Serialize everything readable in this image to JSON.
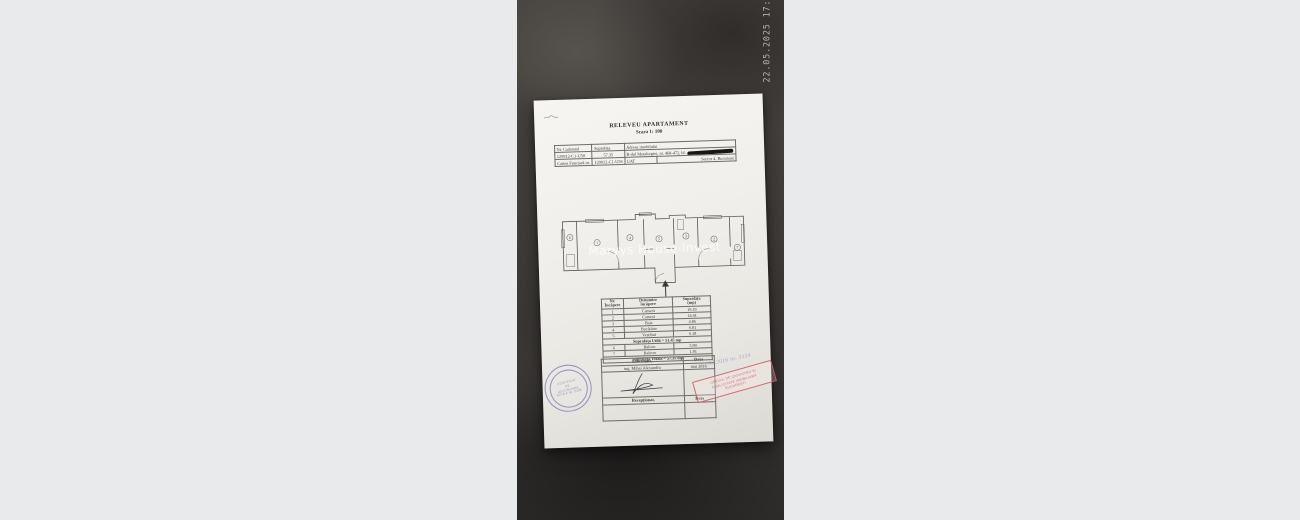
{
  "viewer": {
    "timestamp": "22.05.2025 17:21",
    "watermark": "Maryys House Invest"
  },
  "document": {
    "title": "RELEVEU APARTAMENT",
    "subtitle": "Scara 1: 100",
    "header_table": {
      "nr_cadastral_label": "Nr. Cadastral",
      "suprafata_label": "Suprafața",
      "adresa_label": "Adresa imobilului",
      "cadastral_no": "129912-C1-U58",
      "area_value": "57.35",
      "address": "B-dul Metalurgiei, nr. 468-472, bl.",
      "cf_label": "Cartea Funciară nr.",
      "cf_no": "129912-C1-U58",
      "uat_label": "UAT",
      "uat_value": "Sector 4, București"
    },
    "floor_plan": {
      "rooms": [
        "6",
        "1",
        "4",
        "5",
        "3",
        "2",
        "7"
      ]
    },
    "rooms_table": {
      "headers": {
        "nr1": "Nr.",
        "nr2": "Încăpere",
        "den1": "Denumire",
        "den2": "încăpere",
        "sup1": "Suprafața",
        "sup2": "(mp)"
      },
      "rows": [
        {
          "nr": "1",
          "name": "Cameră",
          "area": "19.19"
        },
        {
          "nr": "2",
          "name": "Cameră",
          "area": "14.41"
        },
        {
          "nr": "3",
          "name": "Baie",
          "area": "4.86"
        },
        {
          "nr": "4",
          "name": "Bucătărie",
          "area": "6.81"
        },
        {
          "nr": "5",
          "name": "Vestibul",
          "area": "6.18"
        }
      ],
      "useful_area_row": "Suprafața Utilă = 51.45 mp",
      "balcony_rows": [
        {
          "nr": "6",
          "name": "Balcon",
          "area": "3.99"
        },
        {
          "nr": "7",
          "name": "Balcon",
          "area": "1.91"
        }
      ],
      "total_area_row": "Suprafața Totală = 57.35 mp"
    },
    "signature_block": {
      "executant_label": "Executant,",
      "data_label": "Data",
      "executant_name": "ing. Mihai Alexandru",
      "data_value": "mai 2016",
      "receptionat_label": "Recepționat,",
      "data_label2": "Data"
    },
    "stamps": {
      "round_lines": [
        "CERTIFICAT",
        "DE",
        "AUTORIZARE",
        "RO-B-F Nr. 0108"
      ],
      "red_lines": [
        "OFICIUL DE CADASTRU ȘI",
        "PUBLICITATE IMOBILIARĂ",
        "BUCUREȘTI"
      ],
      "handwritten_note": "12.06.2016 nr. 3154"
    }
  }
}
